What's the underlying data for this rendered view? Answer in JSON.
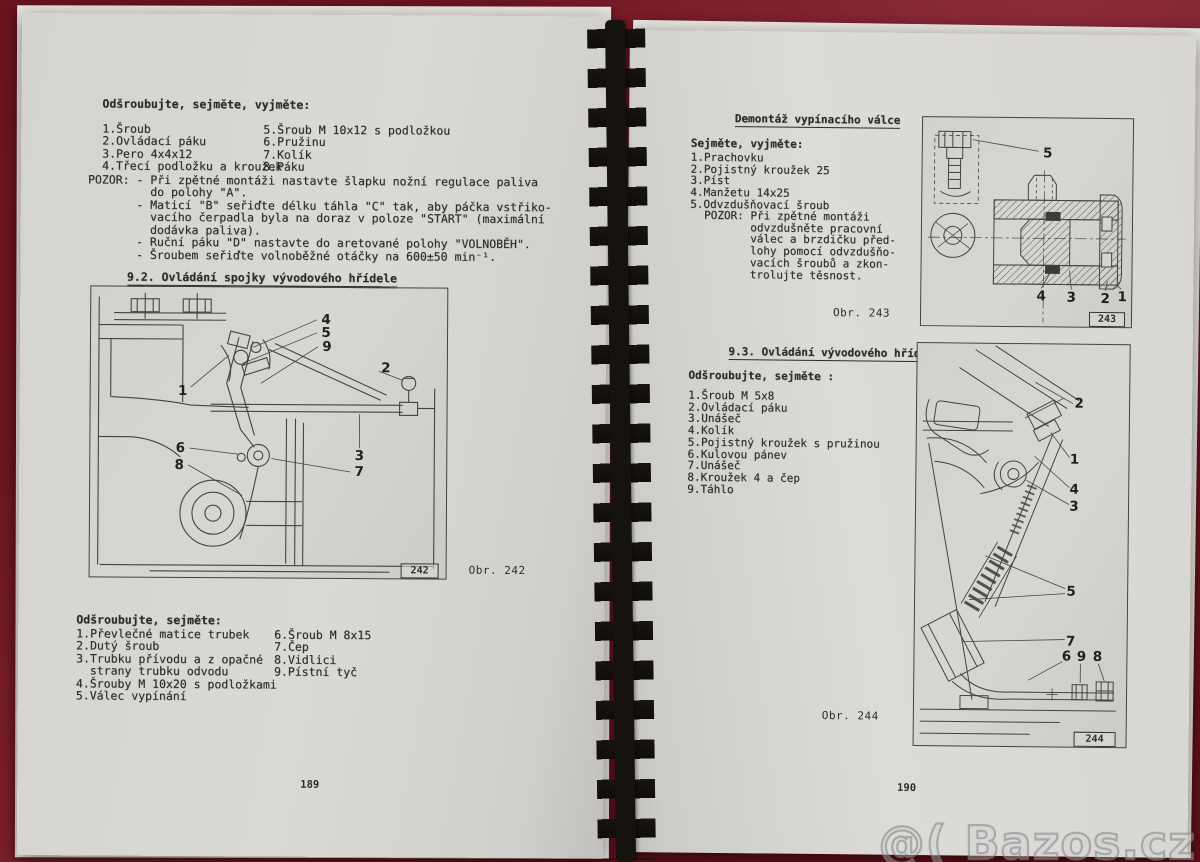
{
  "left_page": {
    "top_list_title": "Odšroubujte, sejměte, vyjměte:",
    "top_list_col1": [
      "1.Šroub",
      "2.Ovládací páku",
      "3.Pero 4x4x12",
      "4.Třecí podložku a kroužek"
    ],
    "top_list_col2": [
      "5.Šroub M 10x12 s podložkou",
      "6.Pružinu",
      "7.Kolík",
      "8.Páku"
    ],
    "pozor_lines": [
      "POZOR: - Při zpětné montáži nastavte šlapku nožní regulace paliva",
      "         do polohy \"A\".",
      "       - Maticí \"B\" seřiďte délku táhla \"C\" tak, aby páčka vstřiko-",
      "         vacího čerpadla byla na doraz v poloze \"START\" (maximální",
      "         dodávka paliva).",
      "       - Ruční páku \"D\" nastavte do aretované polohy \"VOLNOBĚH\".",
      "       - Šroubem seřiďte volnoběžné otáčky na 600±50 min⁻¹."
    ],
    "section_heading": "9.2. Ovládání spojky vývodového hřídele",
    "figure242": {
      "callouts": [
        "4",
        "5",
        "9",
        "1",
        "2",
        "6",
        "8",
        "3",
        "7"
      ],
      "number_box": "242",
      "caption": "Obr. 242"
    },
    "bottom_list_title": "Odšroubujte, sejměte:",
    "bottom_list_col1": [
      "1.Převlečné matice trubek",
      "2.Dutý šroub",
      "3.Trubku přívodu a z opačné",
      "  strany trubku odvodu",
      "4.Šrouby M 10x20 s podložkami",
      "5.Válec vypínání"
    ],
    "bottom_list_col2": [
      "6.Šroub M 8x15",
      "7.Čep",
      "8.Vidlici",
      "9.Pístní tyč"
    ],
    "page_number": "189"
  },
  "right_page": {
    "heading1": "Demontáž vypínacího válce",
    "list1_title": "Sejměte, vyjměte:",
    "list1": [
      "1.Prachovku",
      "2.Pojistný kroužek 25",
      "3.Píst",
      "4.Manžetu 14x25",
      "5.Odvzdušňovací šroub"
    ],
    "pozor_lines": [
      "POZOR: Při zpětné montáži",
      "       odvzdušněte pracovní",
      "       válec a brzdičku před-",
      "       lohy pomocí odvzdušňo-",
      "       vacích šroubů a zkon-",
      "       trolujte těsnost."
    ],
    "figure243": {
      "callouts": [
        "5",
        "4",
        "3",
        "2",
        "1"
      ],
      "number_box": "243",
      "caption": "Obr. 243"
    },
    "section_heading": "9.3. Ovládání vývodového hřídele",
    "list2_title": "Odšroubujte, sejměte :",
    "list2": [
      "1.Šroub M 5x8",
      "2.Ovládací páku",
      "3.Unášeč",
      "4.Kolík",
      "5.Pojistný kroužek s pružinou",
      "6.Kulovou pánev",
      "7.Unášeč",
      "8.Kroužek 4 a čep",
      "9.Táhlo"
    ],
    "figure244": {
      "callouts": [
        "2",
        "1",
        "4",
        "3",
        "5",
        "7",
        "6",
        "9",
        "8"
      ],
      "number_box": "244",
      "caption": "Obr. 244"
    },
    "page_number": "190"
  },
  "watermark": "@( Bazos.cz"
}
